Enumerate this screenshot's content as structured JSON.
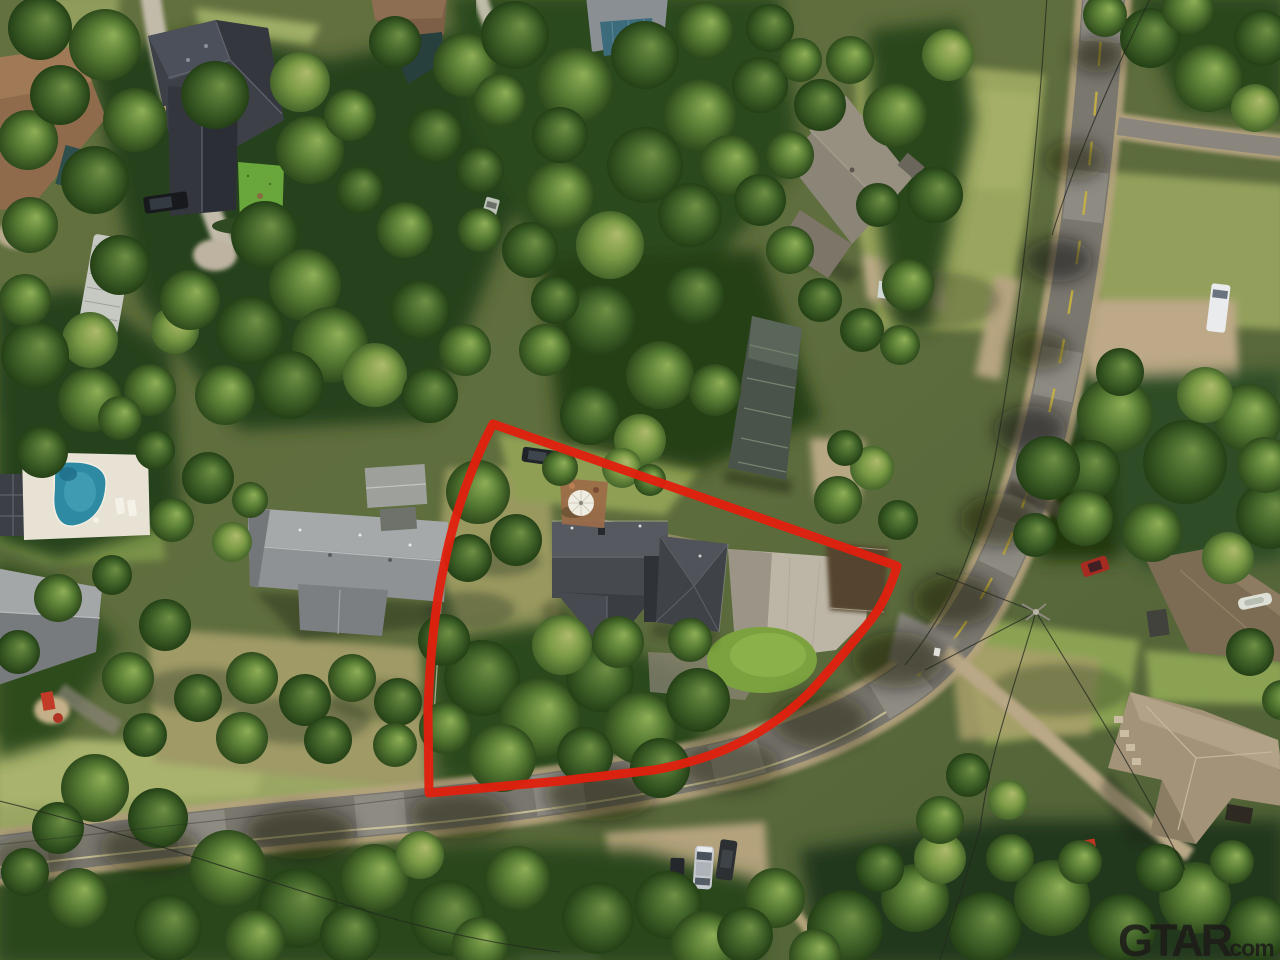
{
  "watermark": {
    "brand": "GTAR",
    "suffix": ".com",
    "color": "#1d1c19"
  },
  "annotation": {
    "type": "property-boundary-outline",
    "color": "#e2200e",
    "shape": "curved corner-lot polygon following the street bend"
  },
  "scene": {
    "kind": "aerial-drone-photograph",
    "setting": "wooded residential neighborhood",
    "subject": "single-family house with dark charcoal roof, concrete driveway, round lawn and patio umbrella inside the red boundary",
    "features": [
      "subject-house",
      "concrete-driveway",
      "round-lawn",
      "patio-umbrella",
      "swimming-pool",
      "pool-deck",
      "curving-street",
      "yellow-center-line",
      "gravel-shoulder",
      "neighbor-house-west",
      "house-top-left",
      "house-top-right",
      "metal-roof-outbuilding",
      "house-bottom-right",
      "house-right-edge",
      "house-left-edge",
      "mobile-trailer",
      "garden-shed",
      "silver-suv",
      "white-van",
      "pickup-truck",
      "red-car",
      "black-suv",
      "red-mower",
      "utility-pole",
      "power-lines",
      "dense-tree-canopy"
    ]
  }
}
